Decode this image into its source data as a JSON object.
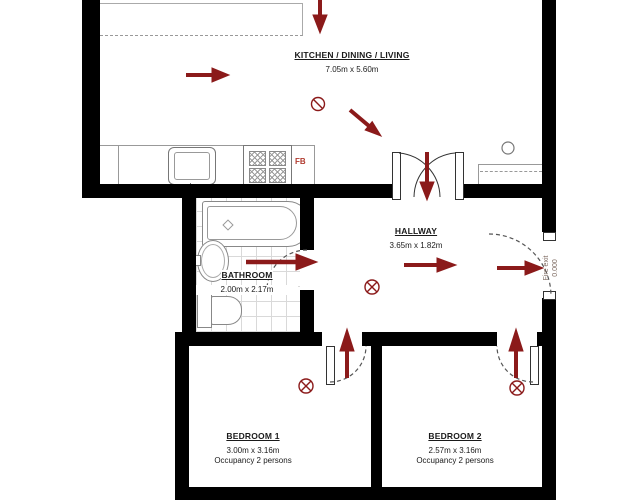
{
  "rooms": {
    "kitchen": {
      "name": "KITCHEN / DINING / LIVING",
      "dimensions": "7.05m x 5.60m"
    },
    "hallway": {
      "name": "HALLWAY",
      "dimensions": "3.65m x 1.82m"
    },
    "bathroom": {
      "name": "BATHROOM",
      "dimensions": "2.00m x 2.17m"
    },
    "bedroom1": {
      "name": "BEDROOM 1",
      "dimensions": "3.00m x 3.16m",
      "occupancy": "Occupancy 2 persons"
    },
    "bedroom2": {
      "name": "BEDROOM 2",
      "dimensions": "2.57m x 3.16m",
      "occupancy": "Occupancy 2 persons"
    }
  },
  "labels": {
    "fire_exit": "Fire exit",
    "fire_exit_value": "0.000",
    "fire_blanket": "FB"
  },
  "colors": {
    "wall": "#000000",
    "escape_arrow": "#8b1a1a",
    "fixture_line": "#8a8a8a",
    "fb_label": "#b03a2e"
  },
  "icons": {
    "escape_arrows": [
      "kitchen-top-exit-arrow",
      "kitchen-route-arrow",
      "kitchen-diagonal-arrow",
      "frenchdoor-arrow",
      "bathroom-exit-arrow",
      "hallway-route-arrow",
      "fire-exit-arrow",
      "bedroom1-exit-arrow",
      "bedroom2-exit-arrow"
    ],
    "symbols": [
      "circled-slash",
      "circled-cross",
      "circle-marker"
    ]
  }
}
